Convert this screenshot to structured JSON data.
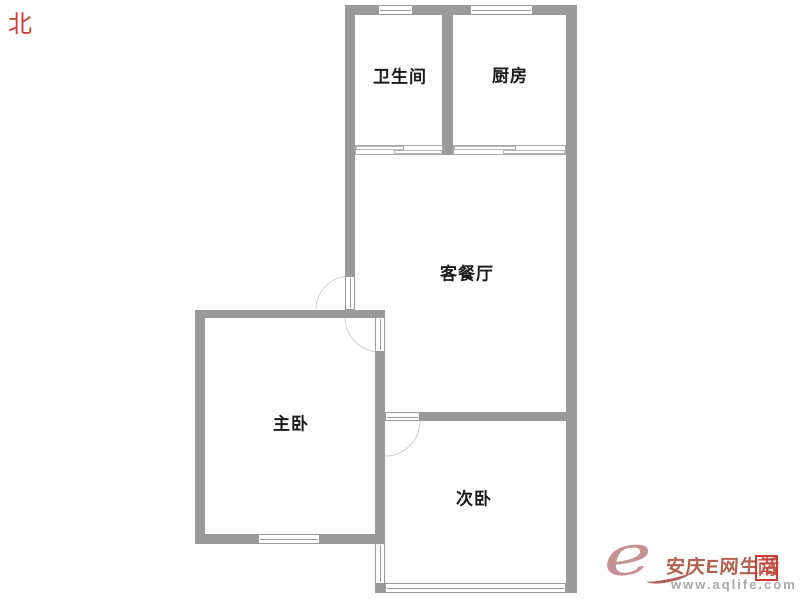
{
  "compass": {
    "north": "北",
    "south": "南"
  },
  "rooms": [
    {
      "id": "bathroom",
      "label": "卫生间"
    },
    {
      "id": "kitchen",
      "label": "厨房"
    },
    {
      "id": "living_dining",
      "label": "客餐厅"
    },
    {
      "id": "master_bedroom",
      "label": "主卧"
    },
    {
      "id": "second_bedroom",
      "label": "次卧"
    }
  ],
  "watermark": {
    "logo_letter": "e",
    "site_name": "安庆E网生活",
    "site_url": "www.aqlife.com"
  },
  "colors": {
    "wall": "#9a9a9a",
    "label": "#1a1a1a",
    "compass-red": "#d03a36",
    "arc": "#cfcfcf",
    "wm-rose": "#c59092",
    "wm-brown": "#b2604e",
    "wm-gray": "#a8a8a8"
  }
}
